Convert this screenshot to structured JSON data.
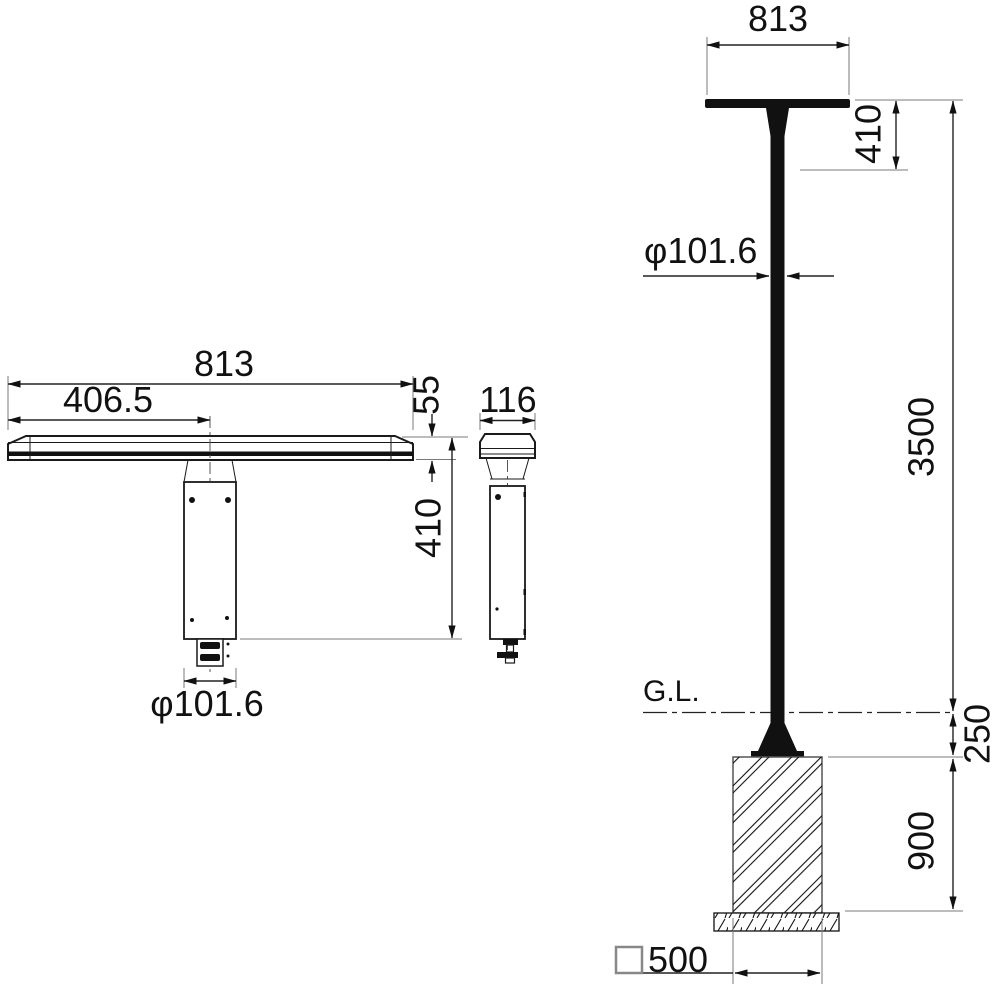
{
  "page": {
    "background": "#ffffff",
    "line_color": "#111111"
  },
  "front_view": {
    "dim_width": "813",
    "dim_half_width": "406.5",
    "dim_bar_height": "55",
    "dim_head_height": "410",
    "dim_pole_diameter": "φ101.6"
  },
  "side_view": {
    "dim_depth": "116"
  },
  "elevation_view": {
    "dim_head_width": "813",
    "dim_head_height": "410",
    "dim_pole_diameter": "φ101.6",
    "dim_pole_height": "3500",
    "dim_base_height": "250",
    "dim_foundation_depth": "900",
    "dim_foundation_width_value": "500",
    "ground_line_label": "G.L."
  }
}
